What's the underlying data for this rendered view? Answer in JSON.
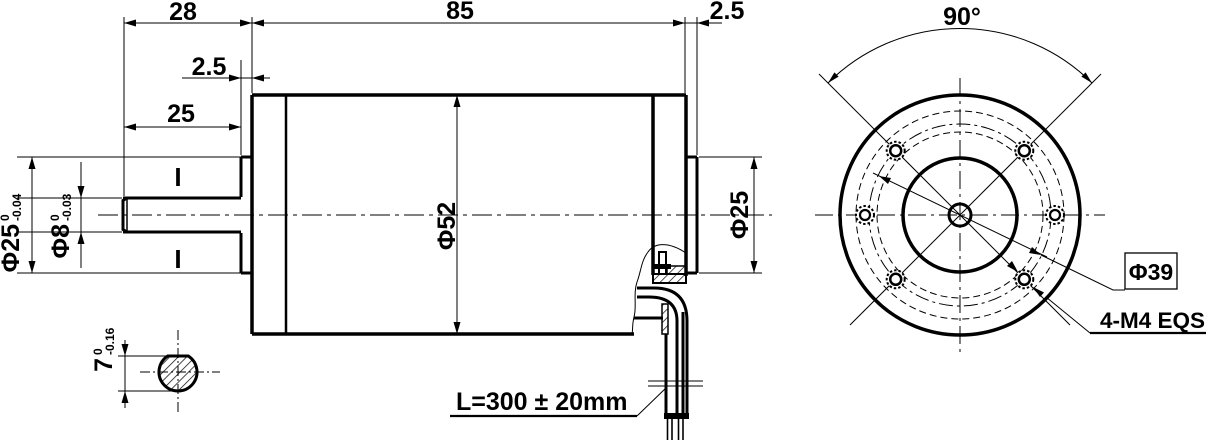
{
  "drawing": {
    "type": "engineering-drawing",
    "colors": {
      "line": "#000000",
      "background": "#ffffff"
    },
    "side_view": {
      "dim_shaft_extension": "28",
      "dim_body_length": "85",
      "dim_rear_boss_width": "2.5",
      "dim_front_boss_width": "2.5",
      "dim_shaft_length": "25",
      "body_diameter": "Φ52",
      "rear_boss_diameter": "Φ25",
      "front_boss_diameter": {
        "main": "Φ25",
        "tol_upper": "0",
        "tol_lower": "-0.04"
      },
      "shaft_diameter": {
        "main": "Φ8",
        "tol_upper": "0",
        "tol_lower": "-0.03"
      },
      "cable_length_label": "L=300 ± 20mm",
      "section_mark_top": "I",
      "section_mark_bottom": "I"
    },
    "section_detail": {
      "flat_height": {
        "main": "7",
        "tol_upper": "0",
        "tol_lower": "-0.16"
      }
    },
    "front_view": {
      "hole_angle": "90°",
      "bolt_circle_diameter": "Φ39",
      "mounting_holes_note": "4-M4 EQS"
    }
  }
}
